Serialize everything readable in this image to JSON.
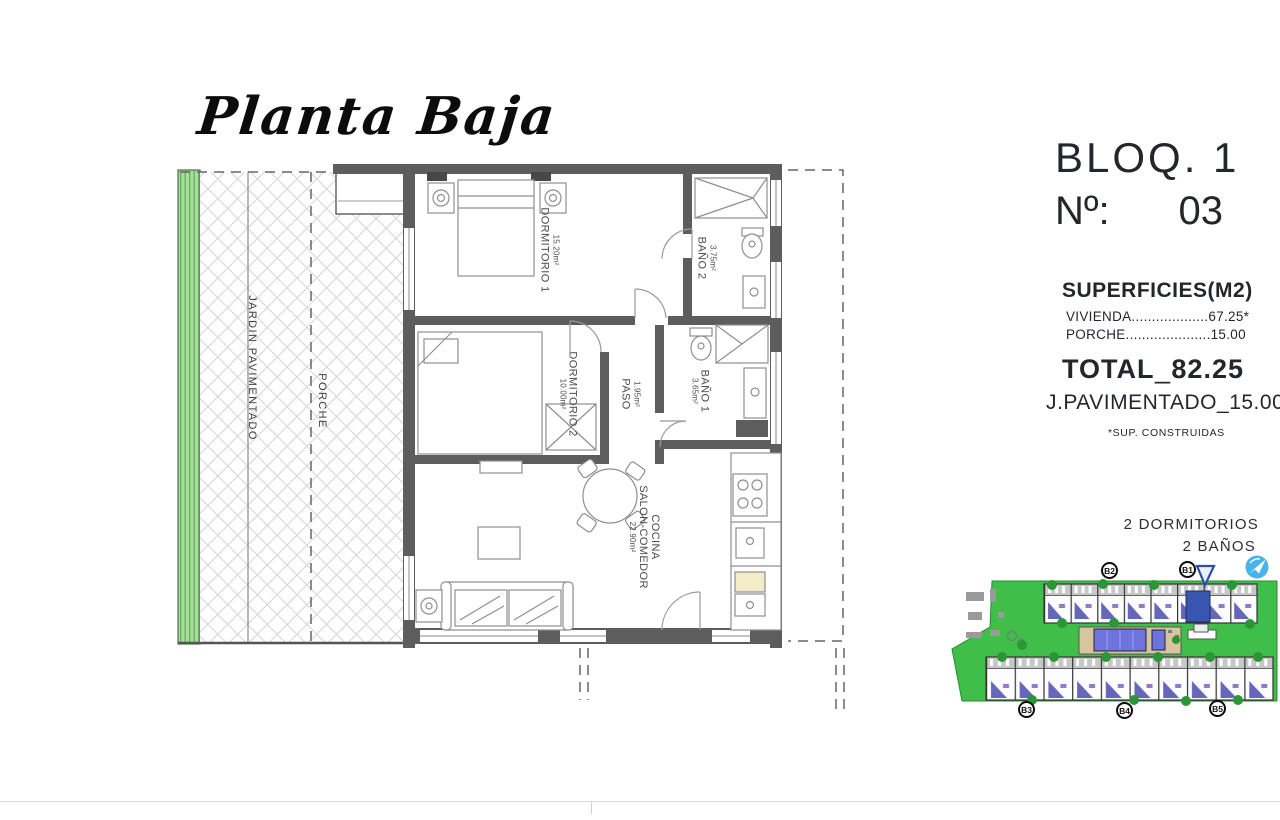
{
  "title": "Planta Baja",
  "colors": {
    "site-green": "#3fbf49",
    "bush-green": "#2a9636",
    "hedge-green": "#a8dc9c",
    "hedge-stripe": "#63b05b",
    "pool-blue": "#6f74dd",
    "unit-blue": "#4a4cae",
    "highlight-blue": "#3a55b0",
    "icon-blue": "#49b4e8",
    "wall-gray": "#5d5d5d",
    "ink": "#23272b"
  },
  "panel": {
    "bloq": "BLOQ. 1",
    "num_label": "Nº:",
    "num_value": "03",
    "superficies_title": "SUPERFICIES(M2)",
    "vivienda_row": "VIVIENDA...................67.25*",
    "porche_row": "PORCHE.....................15.00",
    "total_label": "TOTAL",
    "total_sep": "_",
    "total_value": "82.25",
    "pavimentado_label": "J.PAVIMENTADO",
    "pavimentado_sep": "_",
    "pavimentado_value": "15.00",
    "footnote": "*SUP. CONSTRUIDAS",
    "bedrooms": "2 DORMITORIOS",
    "bathrooms": "2 BAÑOS"
  },
  "floorplan": {
    "rooms": [
      {
        "lines": [
          "DORMITORIO 1"
        ],
        "area": "15.20m²"
      },
      {
        "lines": [
          "BAÑO 2"
        ],
        "area": "3.75m²"
      },
      {
        "lines": [
          "DORMITORIO 2"
        ],
        "area": "10.00m²"
      },
      {
        "lines": [
          "PASO"
        ],
        "area": "1.95m²"
      },
      {
        "lines": [
          "BAÑO 1"
        ],
        "area": "3.65m²"
      },
      {
        "lines": [
          "COCINA",
          "SALON-COMEDOR"
        ],
        "area": "22.90m²"
      }
    ],
    "jardin": "JARDIN PAVIMENTADO",
    "porche": "PORCHE"
  },
  "siteplan": {
    "blocks": [
      "B2",
      "B1",
      "B3",
      "B4",
      "B5"
    ]
  }
}
